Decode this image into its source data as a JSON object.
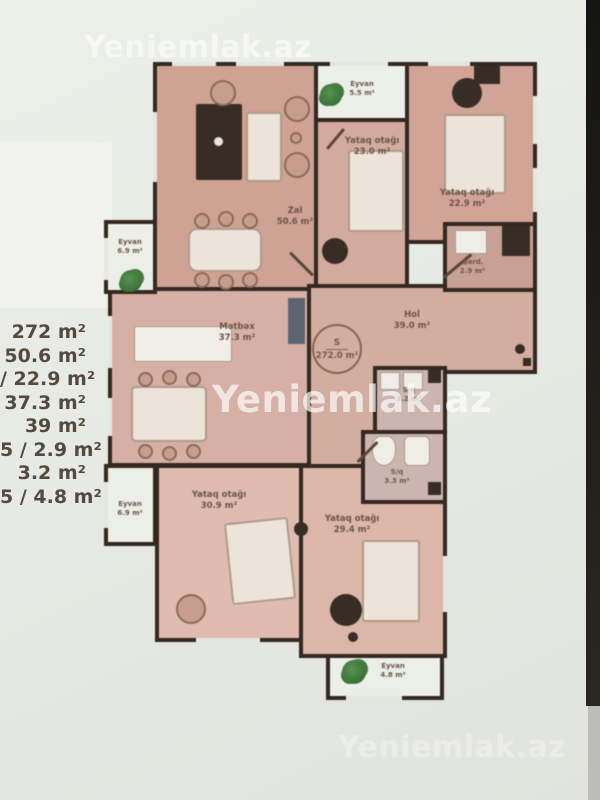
{
  "watermark": {
    "text": "Yeniemlak.az"
  },
  "area_list": {
    "items": [
      "272 m²",
      "50.6 m²",
      "/ 22.9 m²",
      "37.3 m²",
      "39 m²",
      "5 / 2.9 m²",
      "3.2 m²",
      "5 / 4.8 m²"
    ]
  },
  "stamp": {
    "code": "S",
    "total": "272.0 m²"
  },
  "rooms": [
    {
      "id": "zal",
      "name": "Zal",
      "area": "50.6 m²"
    },
    {
      "id": "eyvan-top",
      "name": "Eyvan",
      "area": "5.5 m²"
    },
    {
      "id": "bedroom-1",
      "name": "Yataq otağı",
      "area": "23.0 m²"
    },
    {
      "id": "bedroom-2",
      "name": "Yataq otağı",
      "area": "22.9 m²"
    },
    {
      "id": "qarderob",
      "name": "Qard.",
      "area": "2.9 m²"
    },
    {
      "id": "eyvan-left",
      "name": "Eyvan",
      "area": "6.9 m²"
    },
    {
      "id": "kitchen",
      "name": "Mətbəx",
      "area": "37.3 m²"
    },
    {
      "id": "hall",
      "name": "Hol",
      "area": "39.0 m²"
    },
    {
      "id": "wc-1",
      "name": "S/q",
      "area": "3.2 m²"
    },
    {
      "id": "wc-2",
      "name": "S/q",
      "area": "3.3 m²"
    },
    {
      "id": "eyvan-left-bottom",
      "name": "Eyvan",
      "area": "6.9 m²"
    },
    {
      "id": "bedroom-3",
      "name": "Yataq otağı",
      "area": "30.9 m²"
    },
    {
      "id": "bedroom-4",
      "name": "Yataq otağı",
      "area": "29.4 m²"
    },
    {
      "id": "eyvan-bottom",
      "name": "Eyvan",
      "area": "4.8 m²"
    }
  ],
  "colors": {
    "wall": "#33291f",
    "floor_main": "#d5aa9d",
    "floor_bottom": "#e0bcae",
    "balcony": "#eceee8",
    "paper": "#e7e9e4",
    "plant_green": "#3c7a38",
    "watermark_white": "#ffffff",
    "list_text": "#554a40",
    "photo_edge_black": "#1a1815"
  }
}
